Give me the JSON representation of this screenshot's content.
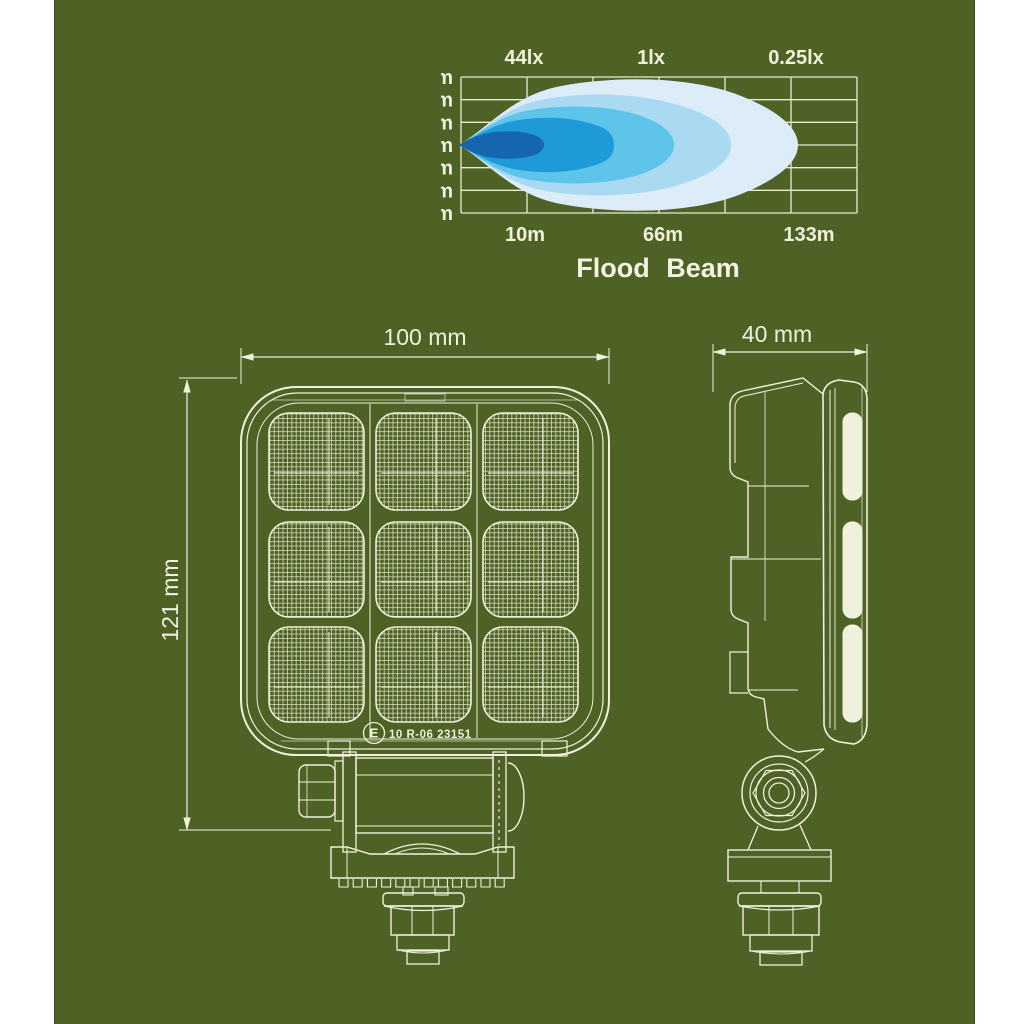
{
  "background": {
    "panel_color": "#4f6226",
    "margin_color": "#ffffff"
  },
  "beam_chart": {
    "title": "Flood Beam",
    "lux_labels": [
      "44lx",
      "1lx",
      "0.25lx"
    ],
    "distance_labels": [
      "10m",
      "66m",
      "133m"
    ],
    "height_labels": [
      "30m",
      "20m",
      "10m",
      "0m",
      "-10m",
      "-20m",
      "-30m"
    ],
    "beam_colors": [
      "#dcedf9",
      "#aad9f2",
      "#5ec4ea",
      "#1f9ad9",
      "#1566ae"
    ]
  },
  "chart_data": {
    "type": "area",
    "title": "Flood Beam",
    "description": "Isolux beam-pattern diagram: nested illumination contours of a flood beam shown over a distance grid",
    "xlabel": "distance",
    "ylabel": "beam spread",
    "x_axis": {
      "tick_labels": [
        "10m",
        "66m",
        "133m"
      ],
      "tick_values_m": [
        10,
        66,
        133
      ]
    },
    "y_axis": {
      "tick_labels": [
        "30m",
        "20m",
        "10m",
        "0m",
        "-10m",
        "-20m",
        "-30m"
      ],
      "tick_values_m": [
        30,
        20,
        10,
        0,
        -10,
        -20,
        -30
      ],
      "range_m": [
        -30,
        30
      ]
    },
    "grid": true,
    "legend": false,
    "isolux_points": [
      {
        "label": "44lx",
        "distance_m": 10
      },
      {
        "label": "1lx",
        "distance_m": 66
      },
      {
        "label": "0.25lx",
        "distance_m": 133
      }
    ],
    "series": [
      {
        "name": "0.25lx contour",
        "color": "#dcedf9",
        "reach_m": 133,
        "max_half_spread_m": 27
      },
      {
        "name": "intermediate contour",
        "color": "#aad9f2",
        "reach_m": 100,
        "max_half_spread_m": 21
      },
      {
        "name": "1lx contour",
        "color": "#5ec4ea",
        "reach_m": 66,
        "max_half_spread_m": 16
      },
      {
        "name": "intermediate contour",
        "color": "#1f9ad9",
        "reach_m": 40,
        "max_half_spread_m": 11
      },
      {
        "name": "44lx contour",
        "color": "#1566ae",
        "reach_m": 10,
        "max_half_spread_m": 6
      }
    ]
  },
  "front_view": {
    "width_dim": "100 mm",
    "height_dim": "121 mm",
    "ece_mark": {
      "circle_letter": "E",
      "approval_text": "10 R-06 23151"
    }
  },
  "side_view": {
    "width_dim": "40 mm"
  }
}
